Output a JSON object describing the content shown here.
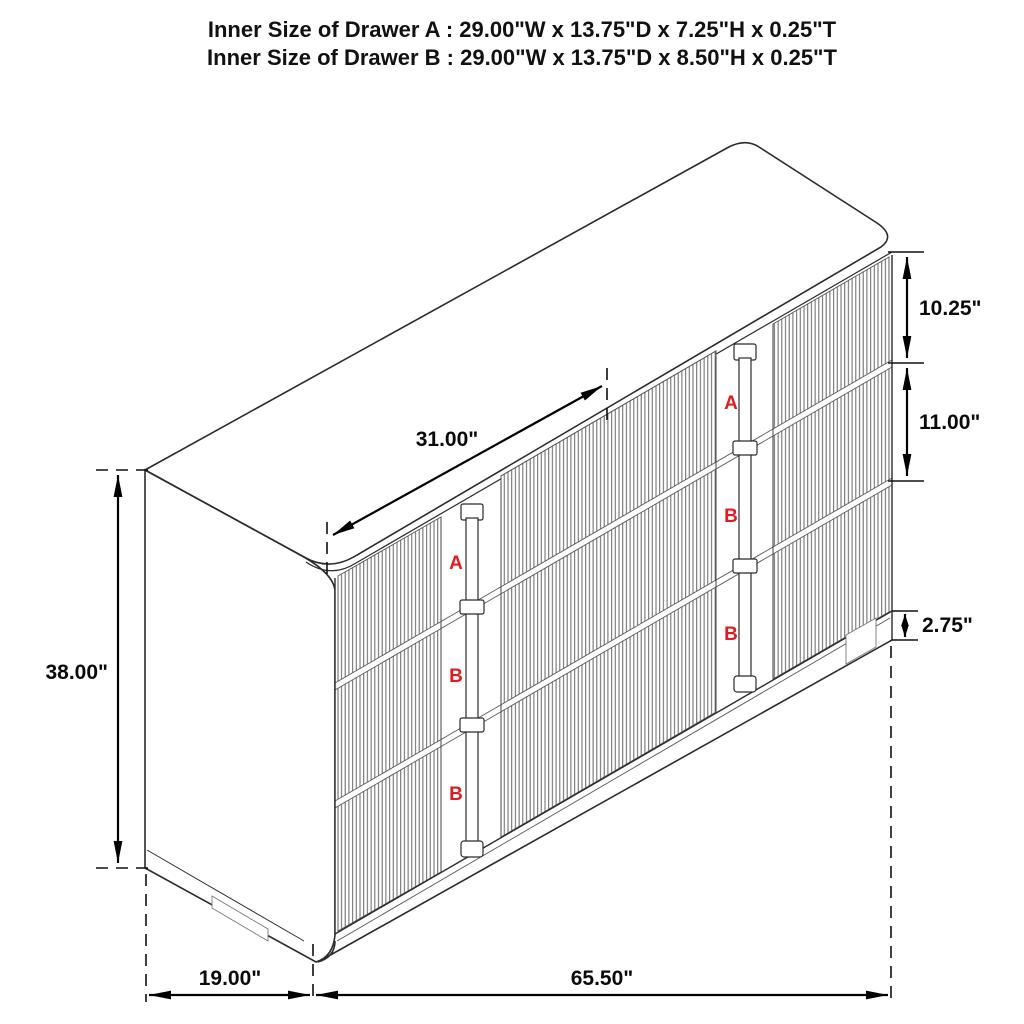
{
  "title": {
    "line1": "Inner Size of Drawer A : 29.00\"W x 13.75\"D x 7.25\"H x 0.25\"T",
    "line2": "Inner Size of Drawer B : 29.00\"W x 13.75\"D x 8.50\"H x 0.25\"T"
  },
  "dimensions": {
    "drawer_width": {
      "label": "31.00\""
    },
    "drawer_a_height": {
      "label": "10.25\""
    },
    "drawer_b_height": {
      "label": "11.00\""
    },
    "base_height": {
      "label": "2.75\""
    },
    "overall_height": {
      "label": "38.00\""
    },
    "overall_depth": {
      "label": "19.00\""
    },
    "overall_width": {
      "label": "65.50\""
    }
  },
  "drawer_labels": {
    "left_bank": [
      "A",
      "B",
      "B"
    ],
    "right_bank": [
      "A",
      "B",
      "B"
    ]
  },
  "colors": {
    "label_red": "#e11b22",
    "line": "#2b2b2b",
    "dimension": "#000000",
    "background": "#ffffff"
  }
}
